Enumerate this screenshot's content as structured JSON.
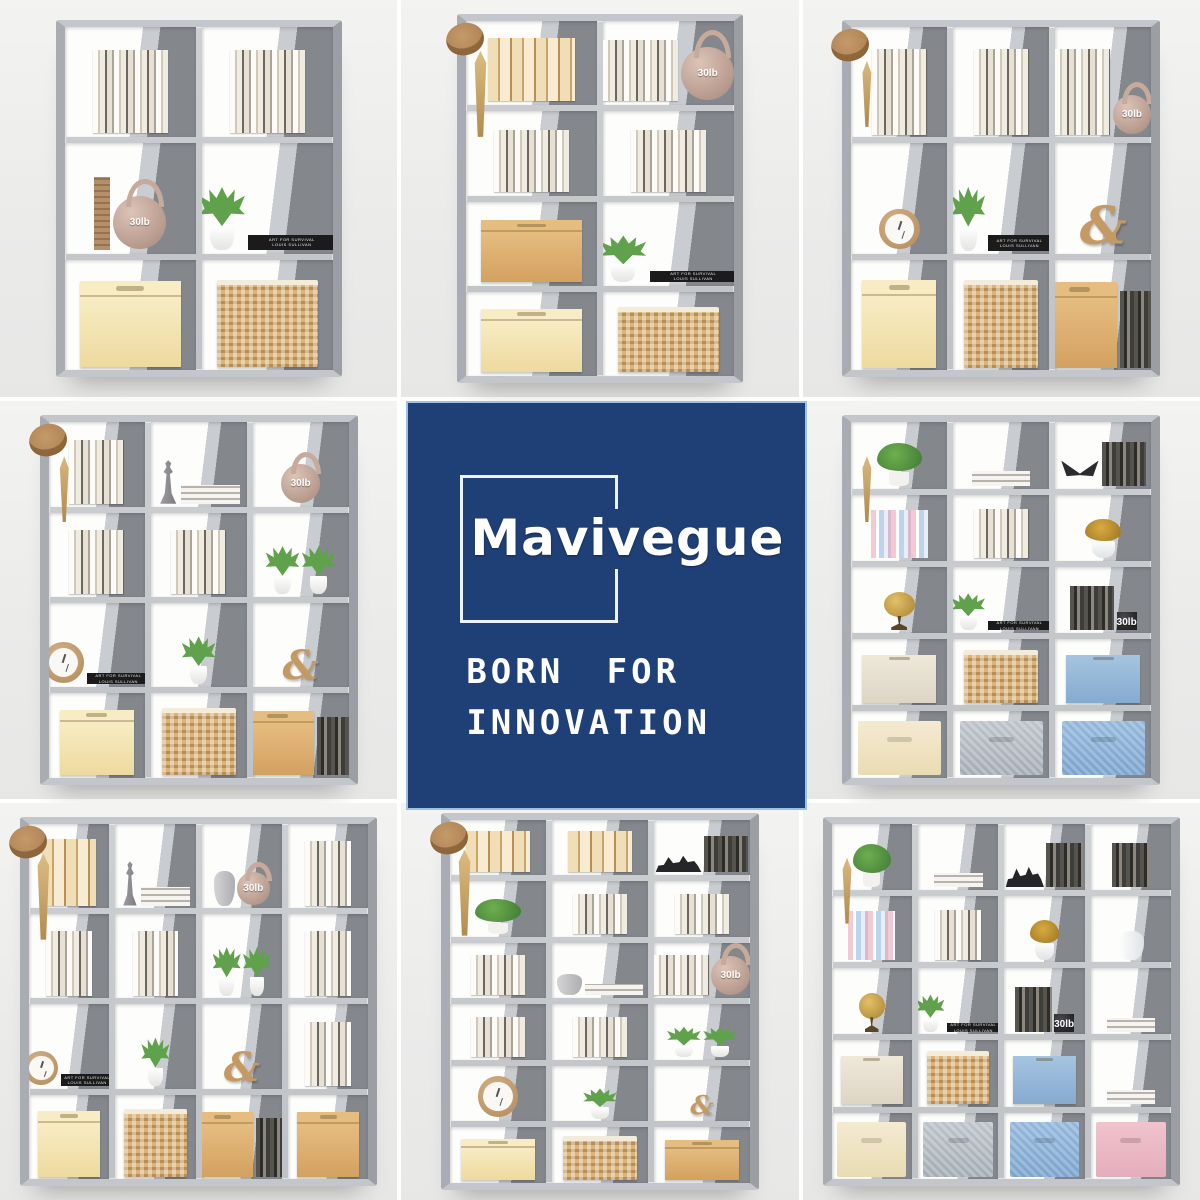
{
  "page": {
    "background": "#ffffff",
    "photo_background": "#ececec"
  },
  "brand": {
    "name": "Mavivegue",
    "tagline_line1": "BORN FOR",
    "tagline_line2": "INNOVATION",
    "square_color": "#1e4076",
    "square_border_color": "#9dc0e6",
    "outline_color": "#eef3fa",
    "text_color": "#ffffff"
  },
  "shared": {
    "kettlebell_label": "30lb",
    "spine_line1": "ART FOR SURVIVAL",
    "spine_line2": "LOUIS SULLIVAN",
    "amp_glyph": "&"
  },
  "colors": {
    "frame_silver": "#c3c6ca",
    "fabric_grey": "#84888d",
    "box_cream": "#f2e3b3",
    "box_kraft": "#daa96a",
    "basket_wicker": "#dcb377",
    "bin_blue": "#8fb4da",
    "drawer_pink": "#eebccb",
    "plant_green": "#5fa24b",
    "kettlebell_tan": "#c4a394"
  },
  "photos": [
    {
      "id": "top-left",
      "name": "6-cube-organizer-photo",
      "cols": 2,
      "rows": 3,
      "accessories": [],
      "cubes": [
        [
          [
            "books"
          ],
          [
            "books"
          ]
        ],
        [
          [
            "board",
            "kettlebell"
          ],
          [
            "plant",
            "stack-black"
          ]
        ],
        [
          [
            "box-cream"
          ],
          [
            "basket"
          ]
        ]
      ]
    },
    {
      "id": "top-middle",
      "name": "8-cube-organizer-photo",
      "cols": 2,
      "rows": 4,
      "accessories": [
        "hat",
        "umbrella"
      ],
      "cubes": [
        [
          [
            "folders"
          ],
          [
            "books",
            "kettlebell"
          ]
        ],
        [
          [
            "books"
          ],
          [
            "books"
          ]
        ],
        [
          [
            "box-tan"
          ],
          [
            "plant",
            "stack-black"
          ]
        ],
        [
          [
            "box-cream"
          ],
          [
            "basket"
          ]
        ]
      ]
    },
    {
      "id": "top-right",
      "name": "9-cube-organizer-photo",
      "cols": 3,
      "rows": 3,
      "accessories": [
        "hat",
        "tassel"
      ],
      "cubes": [
        [
          [
            "books"
          ],
          [
            "books"
          ],
          [
            "books",
            "kettlebell"
          ]
        ],
        [
          [
            "clock"
          ],
          [
            "plant",
            "stack-black"
          ],
          [
            "amp"
          ]
        ],
        [
          [
            "box-cream"
          ],
          [
            "basket"
          ],
          [
            "box-tan",
            "books-dark"
          ]
        ]
      ]
    },
    {
      "id": "middle-left",
      "name": "12-cube-organizer-photo",
      "cols": 3,
      "rows": 4,
      "accessories": [
        "hat",
        "tassel"
      ],
      "cubes": [
        [
          [
            "books"
          ],
          [
            "chess",
            "stack"
          ],
          [
            "kettlebell"
          ]
        ],
        [
          [
            "books"
          ],
          [
            "books"
          ],
          [
            "plant",
            "plant"
          ]
        ],
        [
          [
            "clock",
            "stack-black"
          ],
          [
            "plant"
          ],
          [
            "amp"
          ]
        ],
        [
          [
            "box-cream"
          ],
          [
            "basket"
          ],
          [
            "box-tan",
            "books-dark"
          ]
        ]
      ]
    },
    {
      "id": "middle-right",
      "name": "15-cube-organizer-photo",
      "cols": 3,
      "rows": 5,
      "accessories": [
        "tassel"
      ],
      "cubes": [
        [
          [
            "plant-leafy"
          ],
          [
            "stack"
          ],
          [
            "butterfly",
            "books-dark"
          ]
        ],
        [
          [
            "books-pastel"
          ],
          [
            "books"
          ],
          [
            "flowers-yellow"
          ]
        ],
        [
          [
            "globe"
          ],
          [
            "plant",
            "stack-black"
          ],
          [
            "books-dark",
            "kettlebell-dark"
          ]
        ],
        [
          [
            "bin-beige"
          ],
          [
            "basket"
          ],
          [
            "bin-blue"
          ]
        ],
        [
          [
            "drawer-cream"
          ],
          [
            "drawer-grey"
          ],
          [
            "drawer-blue"
          ]
        ]
      ]
    },
    {
      "id": "bottom-left",
      "name": "16-cube-organizer-photo",
      "cols": 4,
      "rows": 4,
      "accessories": [
        "hat",
        "umbrella"
      ],
      "cubes": [
        [
          [
            "folders"
          ],
          [
            "chess",
            "stack"
          ],
          [
            "vase",
            "kettlebell"
          ],
          [
            "books"
          ]
        ],
        [
          [
            "books"
          ],
          [
            "books"
          ],
          [
            "plant",
            "plant"
          ],
          [
            "books"
          ]
        ],
        [
          [
            "clock",
            "stack-black"
          ],
          [
            "plant"
          ],
          [
            "amp"
          ],
          [
            "books"
          ]
        ],
        [
          [
            "box-cream"
          ],
          [
            "basket"
          ],
          [
            "box-tan",
            "books-dark"
          ],
          [
            "box-tan"
          ]
        ]
      ]
    },
    {
      "id": "bottom-middle",
      "name": "18-cube-organizer-photo",
      "cols": 3,
      "rows": 6,
      "accessories": [
        "hat",
        "umbrella"
      ],
      "cubes": [
        [
          [
            "folders"
          ],
          [
            "folders"
          ],
          [
            "dino",
            "books-dark"
          ]
        ],
        [
          [
            "plant-leafy"
          ],
          [
            "books"
          ],
          [
            "books"
          ]
        ],
        [
          [
            "books"
          ],
          [
            "vase",
            "stack"
          ],
          [
            "books",
            "kettlebell"
          ]
        ],
        [
          [
            "books"
          ],
          [
            "books"
          ],
          [
            "plant",
            "plant"
          ]
        ],
        [
          [
            "clock"
          ],
          [
            "plant"
          ],
          [
            "amp"
          ]
        ],
        [
          [
            "box-cream"
          ],
          [
            "basket"
          ],
          [
            "box-tan"
          ]
        ]
      ]
    },
    {
      "id": "bottom-right",
      "name": "20-cube-organizer-photo",
      "cols": 4,
      "rows": 5,
      "accessories": [
        "tassel"
      ],
      "cubes": [
        [
          [
            "plant-leafy"
          ],
          [
            "stack"
          ],
          [
            "dino",
            "books-dark"
          ],
          [
            "books-dark"
          ]
        ],
        [
          [
            "books-pastel"
          ],
          [
            "books"
          ],
          [
            "flowers-yellow"
          ],
          [
            "vase-white"
          ]
        ],
        [
          [
            "globe"
          ],
          [
            "plant",
            "stack-black"
          ],
          [
            "books-dark",
            "kettlebell-dark"
          ],
          [
            "stack"
          ]
        ],
        [
          [
            "bin-beige"
          ],
          [
            "basket"
          ],
          [
            "bin-blue"
          ],
          [
            "stack"
          ]
        ],
        [
          [
            "drawer-cream"
          ],
          [
            "drawer-grey"
          ],
          [
            "drawer-blue"
          ],
          [
            "drawer-pink"
          ]
        ]
      ]
    }
  ]
}
